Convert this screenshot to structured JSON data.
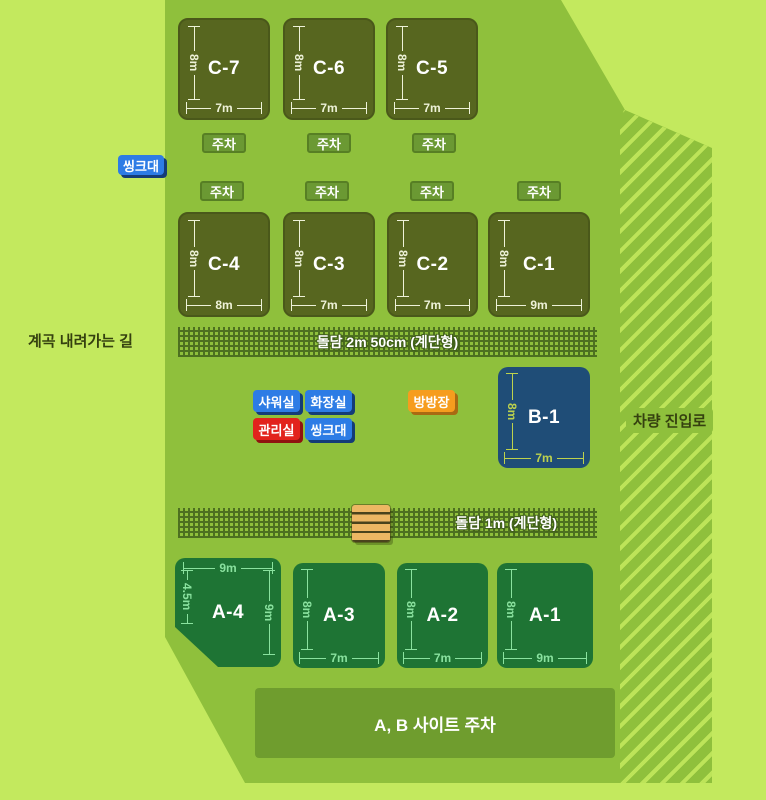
{
  "outside": {
    "valley_path_label": "계곡 내려가는 길",
    "vehicle_road_label": "차량 진입로"
  },
  "walls": {
    "upper_label": "돌담 2m 50cm (계단형)",
    "lower_label": "돌담 1m (계단형)"
  },
  "badges": {
    "parking": "주차",
    "sink_left": "씽크대"
  },
  "facilities": {
    "shower": "샤워실",
    "toilet": "화장실",
    "office": "관리실",
    "sink": "씽크대",
    "trampoline": "방방장"
  },
  "sites": {
    "c": [
      {
        "id": "C-7",
        "width": "7m",
        "height": "8m"
      },
      {
        "id": "C-6",
        "width": "7m",
        "height": "8m"
      },
      {
        "id": "C-5",
        "width": "7m",
        "height": "8m"
      },
      {
        "id": "C-4",
        "width": "8m",
        "height": "8m"
      },
      {
        "id": "C-3",
        "width": "7m",
        "height": "8m"
      },
      {
        "id": "C-2",
        "width": "7m",
        "height": "8m"
      },
      {
        "id": "C-1",
        "width": "9m",
        "height": "8m"
      }
    ],
    "b": [
      {
        "id": "B-1",
        "width": "7m",
        "height": "8m"
      }
    ],
    "a": [
      {
        "id": "A-4",
        "top": "9m",
        "left": "4.5m",
        "right": "9m"
      },
      {
        "id": "A-3",
        "width": "7m",
        "height": "8m"
      },
      {
        "id": "A-2",
        "width": "7m",
        "height": "8m"
      },
      {
        "id": "A-1",
        "width": "9m",
        "height": "8m"
      }
    ]
  },
  "parking_area": {
    "label": "A, B 사이트 주차"
  },
  "colors": {
    "outer_bg": "#c3e95e",
    "map_bg": "#8fc03c",
    "c_site": "#57661f",
    "a_site": "#1e7434",
    "b_site": "#1f4d77",
    "parking_strip": "#6f9d2e",
    "facility_blue": "#2d7ce5",
    "facility_red": "#e2231c",
    "facility_orange": "#f69d1e"
  }
}
